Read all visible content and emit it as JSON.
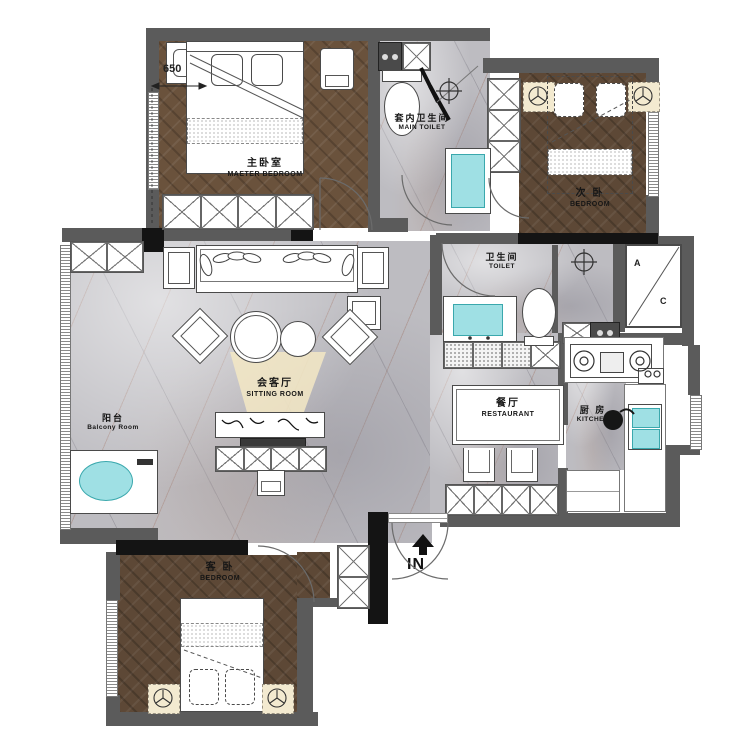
{
  "plan": {
    "type": "apartment-floor-plan",
    "rooms": {
      "master_bedroom": {
        "zh": "主卧室",
        "en": "MAETER BEDROOM"
      },
      "main_toilet": {
        "zh": "套内卫生间",
        "en": "MAIN TOILET"
      },
      "second_bedroom": {
        "zh": "次 卧",
        "en": "BEDROOM"
      },
      "balcony": {
        "zh": "阳台",
        "en": "Balcony Room"
      },
      "sitting_room": {
        "zh": "会客厅",
        "en": "SITTING ROOM"
      },
      "toilet": {
        "zh": "卫生间",
        "en": "TOILET"
      },
      "restaurant": {
        "zh": "餐厅",
        "en": "RESTAURANT"
      },
      "kitchen": {
        "zh": "厨 房",
        "en": "KITCHEN"
      },
      "guest_bedroom": {
        "zh": "客 卧",
        "en": "BEDROOM"
      }
    },
    "annotations": {
      "dimension": "650",
      "entrance": "IN",
      "ac_top": "A",
      "ac_bottom": "C"
    },
    "colors": {
      "wall_gray": "#5b5b5b",
      "wall_black": "#141414",
      "wood_floor": "#6a523c",
      "marble_floor": "#bdbcc1",
      "fixture_cyan": "#9fe0e4",
      "light_beige": "#f3e7c4"
    }
  }
}
